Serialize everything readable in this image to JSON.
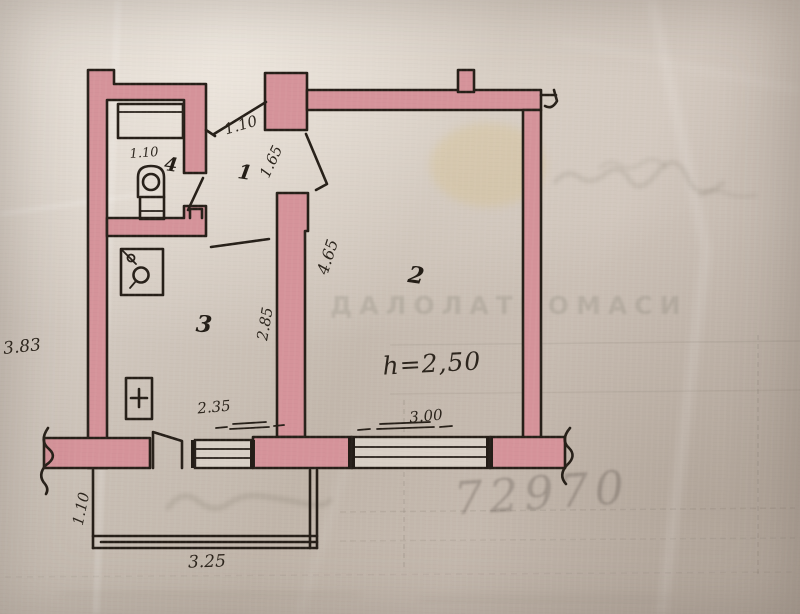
{
  "document": {
    "kind": "scanned hand-drawn apartment floor plan",
    "paper_color": "#cdc3b9",
    "wall_color": "#d5939a",
    "ink_color": "#261f18"
  },
  "rooms": [
    {
      "id": "room-1",
      "label": "1"
    },
    {
      "id": "room-2",
      "label": "2"
    },
    {
      "id": "room-3",
      "label": "3"
    },
    {
      "id": "room-4",
      "label": "4"
    }
  ],
  "dimensions": {
    "entry_door": "1.10",
    "room4_width": "1.10",
    "hall_to_room2_door": "1.65",
    "room2_left_wall": "4.65",
    "room3_right_wall": "2.85",
    "room3_width": "2.35",
    "room2_window": "3.00",
    "balcony_width": "3.25",
    "balcony_depth": "1.10",
    "left_margin_note": "3.83",
    "ceiling_height": "h=2,50"
  },
  "symbols": {
    "toilet": "toilet-icon",
    "sink": "sink-icon",
    "stove": "stove-icon"
  },
  "watermarks": {
    "title": "ДАЛОЛАТНОМАСИ",
    "number": "72970"
  }
}
